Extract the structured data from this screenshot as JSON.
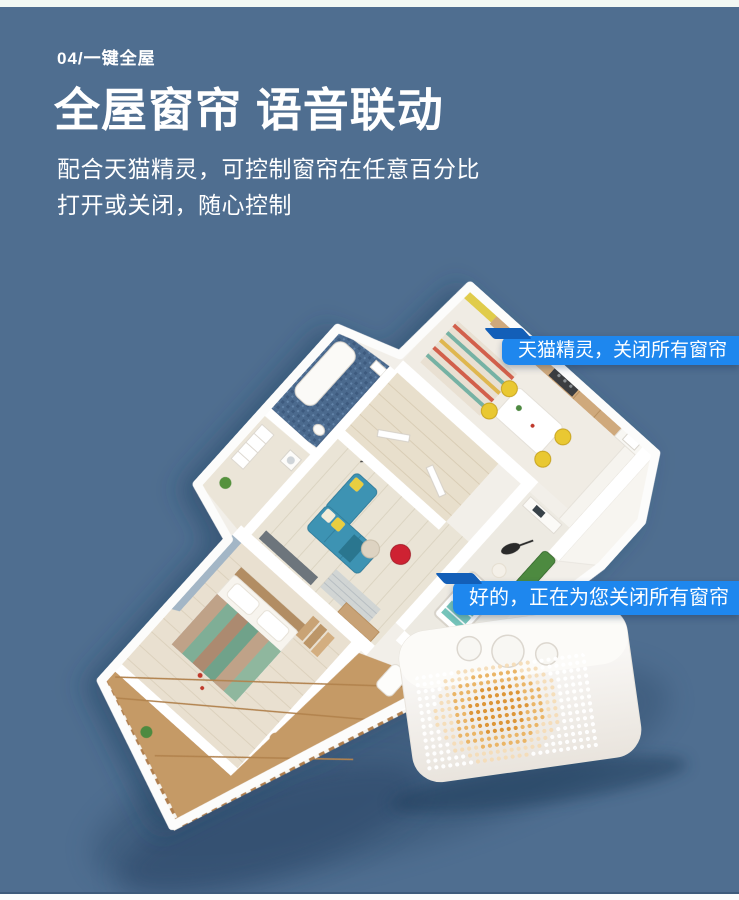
{
  "page": {
    "bg": "#4f6e90",
    "top_strip": "#f2f8f4",
    "bottom_strip": "#fbfdfd"
  },
  "header": {
    "index": "04/一键全屋",
    "title": "全屋窗帘 语音联动",
    "subtitle": [
      "配合天猫精灵，可控制窗帘在任意百分比",
      "打开或关闭，随心控制"
    ]
  },
  "bubbles": {
    "user": "天猫精灵，关闭所有窗帘",
    "assistant": "好的，正在为您关闭所有窗帘",
    "bubble_blue": "#1e87ee",
    "tail_blue": "#135fb8"
  },
  "speaker": {
    "body": "#f6f4f0",
    "dot_orange": "#dd9638",
    "dot_orange_light": "#eab567",
    "dot_ring": "#f4dcb7",
    "dot_white": "#ffffff"
  },
  "house_colors": {
    "wall": "#fcfcfb",
    "floor_light": "#eae4d6",
    "hall_wood": "#e8dfcc",
    "balcony_wood": "#c59a66",
    "bathroom_tile": "#4b6a8e",
    "sofa_teal": "#3e93b3",
    "chair_red": "#ce2332",
    "stool_yellow": "#e9c832",
    "sofa_green": "#4d8a41",
    "crib_teal": "#74c4ba",
    "kitchen_yellow": "#e0cc4b"
  }
}
